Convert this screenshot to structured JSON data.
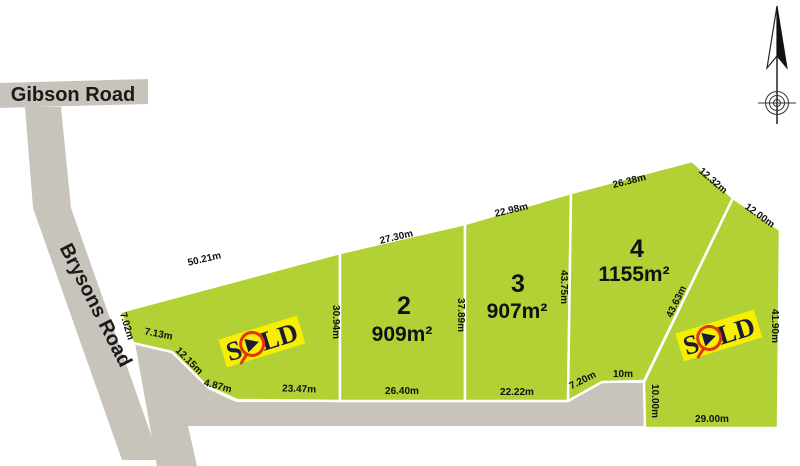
{
  "colors": {
    "lot_green": "#b2d135",
    "road_gray": "#c9c4bb",
    "sold_yellow": "#f8ee00",
    "sold_text_navy": "#1b1b38",
    "sold_red": "#e2340d",
    "label_black": "#111111"
  },
  "roads": {
    "gibson": "Gibson Road",
    "brysons": "Brysons Road"
  },
  "sold_label": "SOLD",
  "icons": {
    "north_arrow": "north-arrow-icon",
    "crosshair": "crosshair-icon",
    "sold_logo": "sold-logo-icon"
  },
  "lots": [
    {
      "name": "lot-1",
      "sold": true,
      "dims": {
        "top": "50.21m",
        "left_upper": "7.02m",
        "left": "7.13m",
        "left_diag": "12.15m",
        "corner": "4.87m",
        "bottom": "23.47m",
        "right": "30.94m"
      }
    },
    {
      "name": "lot-2",
      "number": "2",
      "area": "909m²",
      "dims": {
        "top": "27.30m",
        "bottom": "26.40m",
        "right": "37.89m"
      }
    },
    {
      "name": "lot-3",
      "number": "3",
      "area": "907m²",
      "dims": {
        "top": "22.98m",
        "bottom": "22.22m",
        "right": "43.75m"
      }
    },
    {
      "name": "lot-4",
      "number": "4",
      "area": "1155m²",
      "dims": {
        "top": "26.38m",
        "top_right": "12.32m",
        "right_upper": "12.00m",
        "right_diag": "43.63m",
        "bottom_left": "7.20m",
        "bottom": "10m"
      }
    },
    {
      "name": "lot-5",
      "sold": true,
      "dims": {
        "right": "41.90m",
        "left": "10.00m",
        "bottom": "29.00m"
      }
    }
  ]
}
